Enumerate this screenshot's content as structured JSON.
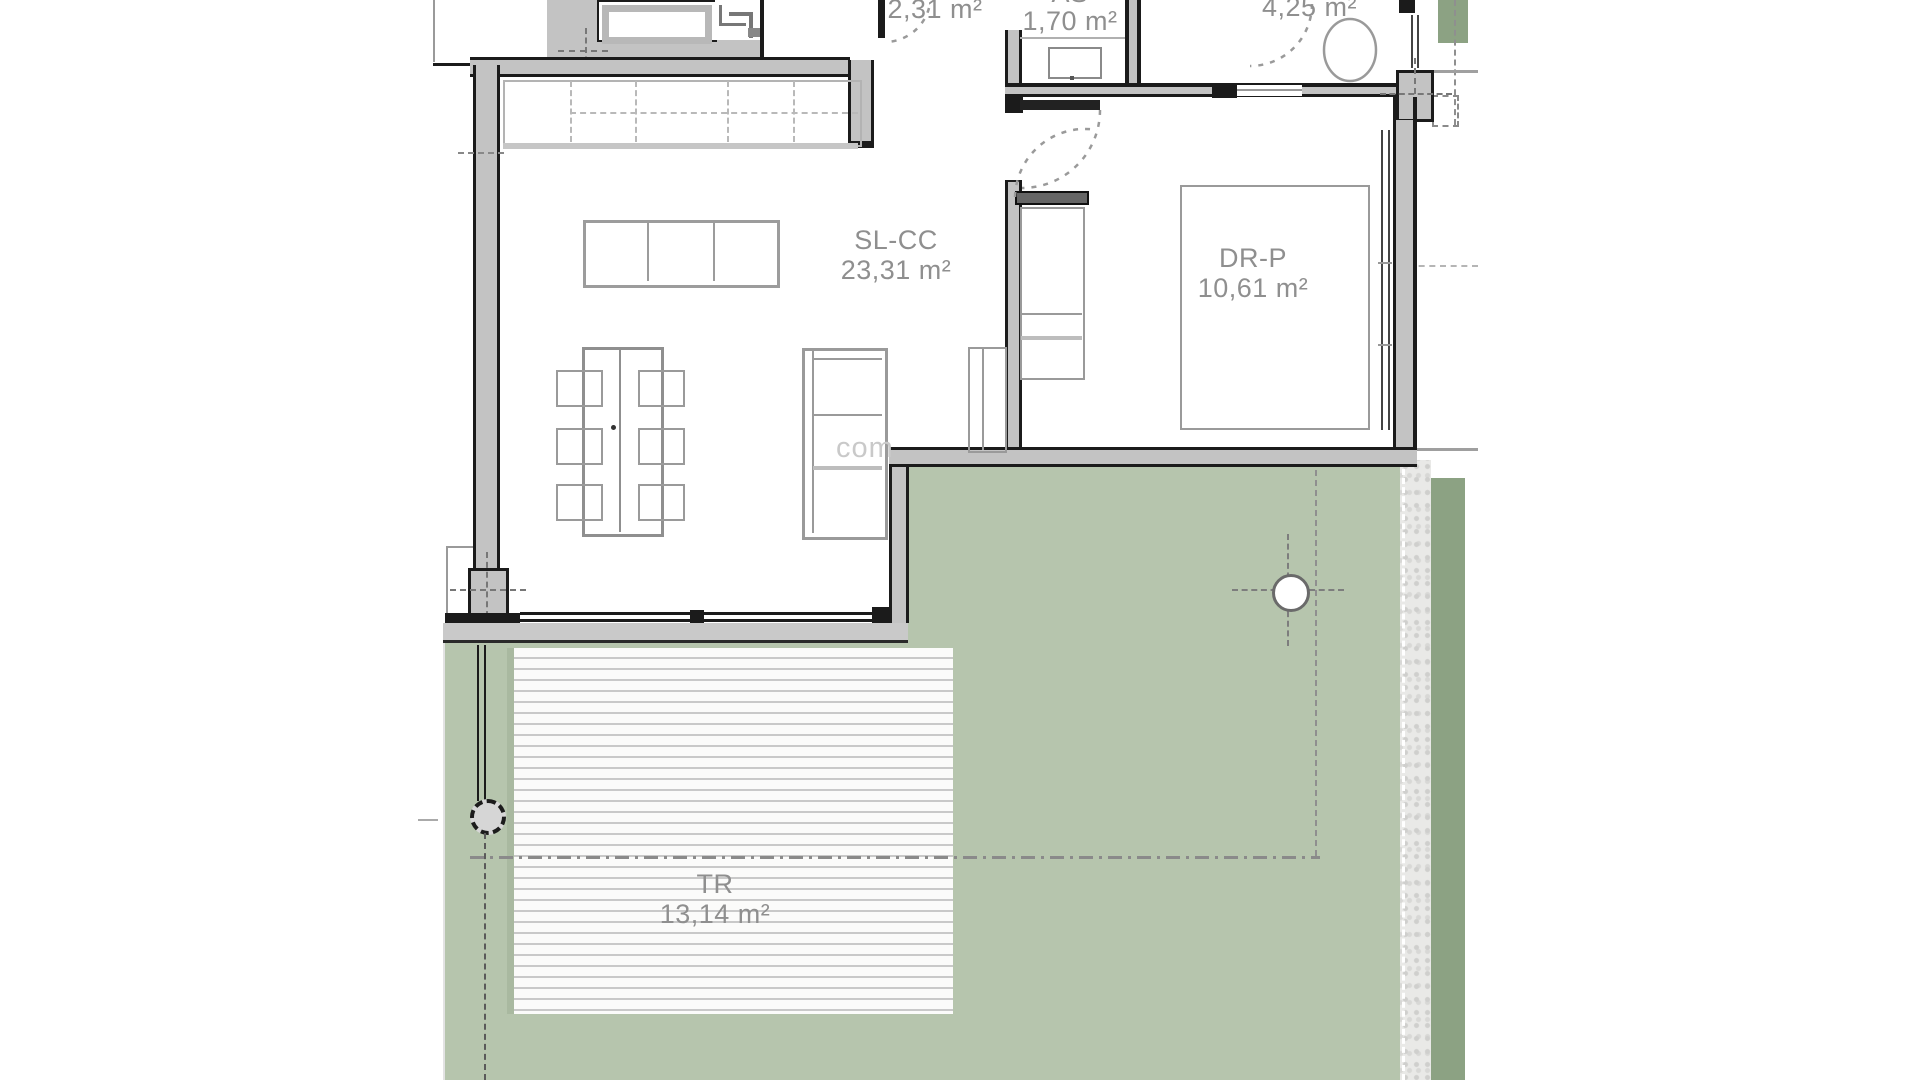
{
  "plan": {
    "type": "apartment floor plan",
    "watermark": "com",
    "rooms": {
      "hall": {
        "area": "2,31 m²"
      },
      "bathroom_small": {
        "code": "AS",
        "area": "1,70 m²"
      },
      "bathroom_main": {
        "area": "4,25 m²"
      },
      "living": {
        "code": "SL-CC",
        "area": "23,31 m²"
      },
      "bedroom": {
        "code": "DR-P",
        "area": "10,61 m²"
      },
      "terrace": {
        "code": "TR",
        "area": "13,14 m²"
      }
    },
    "colors": {
      "lawn": "#b6c5ad",
      "lawn_dark": "#8ca283",
      "wall": "#1b1b1b",
      "wall_fill": "#c3c3c3",
      "furniture_line": "#9a9a9a",
      "label_text": "#8f8f8f"
    }
  }
}
